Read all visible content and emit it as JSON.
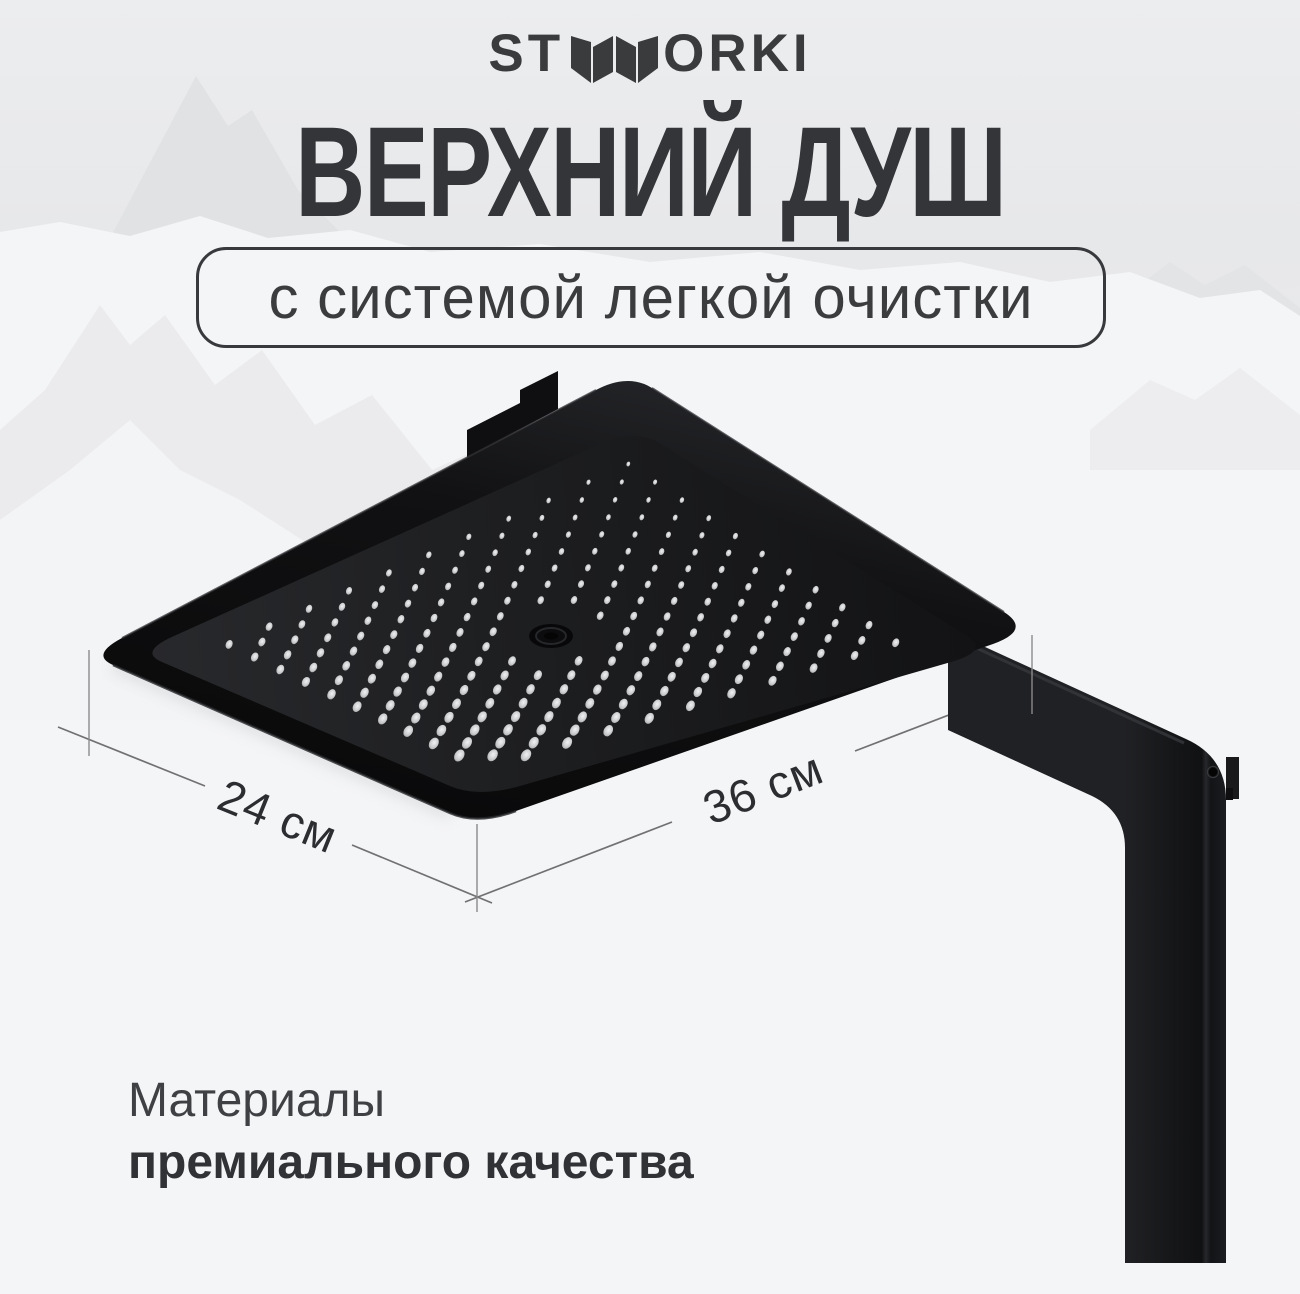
{
  "brand": {
    "name": "STWORKI",
    "logo_left": "ST",
    "logo_right": "ORKI"
  },
  "hero": {
    "title": "ВЕРХНИЙ ДУШ",
    "badge": "с системой легкой очистки"
  },
  "dimensions": {
    "left": "24 см",
    "right": "36 см"
  },
  "materials": {
    "line1": "Материалы",
    "line2": "премиального качества"
  },
  "colors": {
    "background": "#eaebed",
    "mountain_gray": "#e2e3e5",
    "mountain_white": "#f5f6f7",
    "text_primary": "#333538",
    "logo": "#3a3b3d",
    "product_black": "#121214",
    "nozzle": "#d3d4d6",
    "dimension_line": "#717174"
  }
}
